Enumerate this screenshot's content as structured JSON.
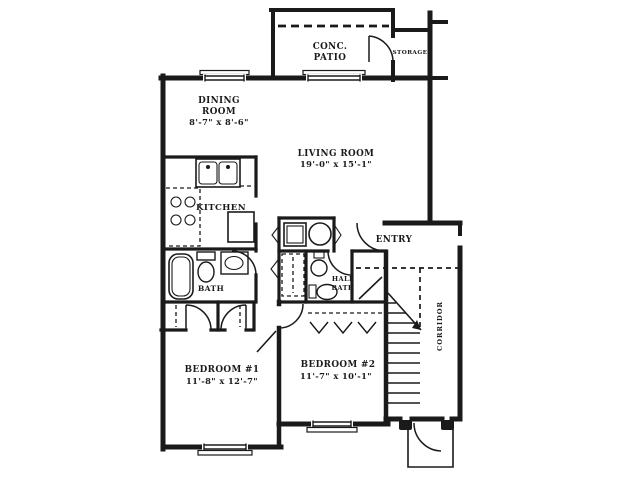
{
  "plan": {
    "type": "apartment-floor-plan",
    "colors": {
      "ink": "#1a1a1a",
      "background": "#ffffff"
    },
    "rooms": {
      "patio": {
        "line1": "CONC.",
        "line2": "PATIO"
      },
      "storage": {
        "label": "STORAGE"
      },
      "dining": {
        "line1": "DINING",
        "line2": "ROOM",
        "dims": "8'-7\" x 8'-6\""
      },
      "living": {
        "label": "LIVING ROOM",
        "dims": "19'-0\" x 15'-1\""
      },
      "kitchen": {
        "label": "KITCHEN"
      },
      "bath": {
        "label": "BATH"
      },
      "half_bath": {
        "line1": "HALF",
        "line2": "BATH"
      },
      "entry": {
        "label": "ENTRY"
      },
      "corridor": {
        "label": "CORRIDOR"
      },
      "bedroom1": {
        "label": "BEDROOM #1",
        "dims": "11'-8\" x 12'-7\""
      },
      "bedroom2": {
        "label": "BEDROOM #2",
        "dims": "11'-7\" x 10'-1\""
      }
    }
  }
}
